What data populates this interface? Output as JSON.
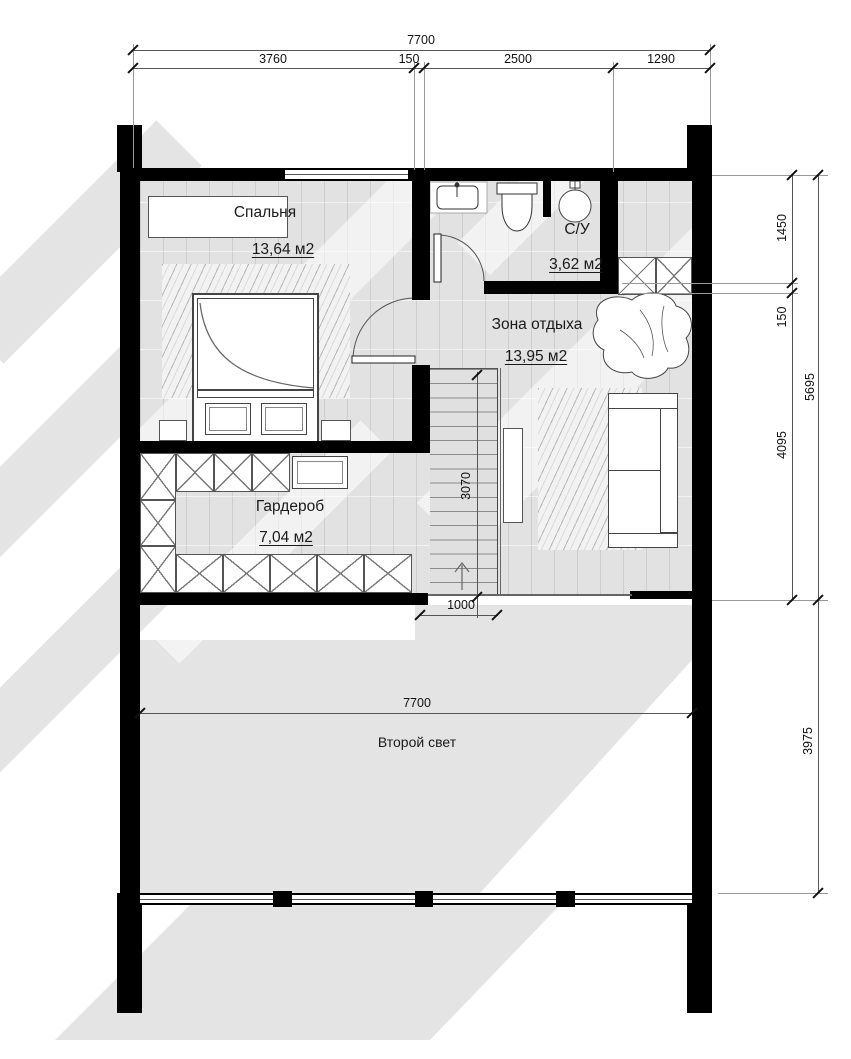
{
  "drawing": {
    "type": "floor-plan",
    "floor_note": "second floor plan with double-height void"
  },
  "rooms": {
    "bedroom": {
      "name": "Спальня",
      "area": "13,64 м2"
    },
    "bathroom": {
      "name": "С/У",
      "area": "3,62 м2"
    },
    "lounge": {
      "name": "Зона отдыха",
      "area": "13,95 м2"
    },
    "wardrobe": {
      "name": "Гардероб",
      "area": "7,04 м2"
    },
    "second_light": {
      "name": "Второй свет"
    }
  },
  "dims": {
    "top_total": "7700",
    "top_seg1": "3760",
    "top_seg2": "150",
    "top_seg3": "2500",
    "top_seg4": "1290",
    "right_seg1": "1450",
    "right_seg2": "150",
    "right_seg3": "4095",
    "right_total": "5695",
    "right_bottom": "3975",
    "stair_run": "3070",
    "stair_exit": "1000",
    "mid_width": "7700"
  },
  "colors": {
    "wall": "#000000",
    "floor": "#e2e2e2",
    "shadow": "#e4e4e4",
    "dim_line": "#555555",
    "text": "#1a1a1a"
  }
}
